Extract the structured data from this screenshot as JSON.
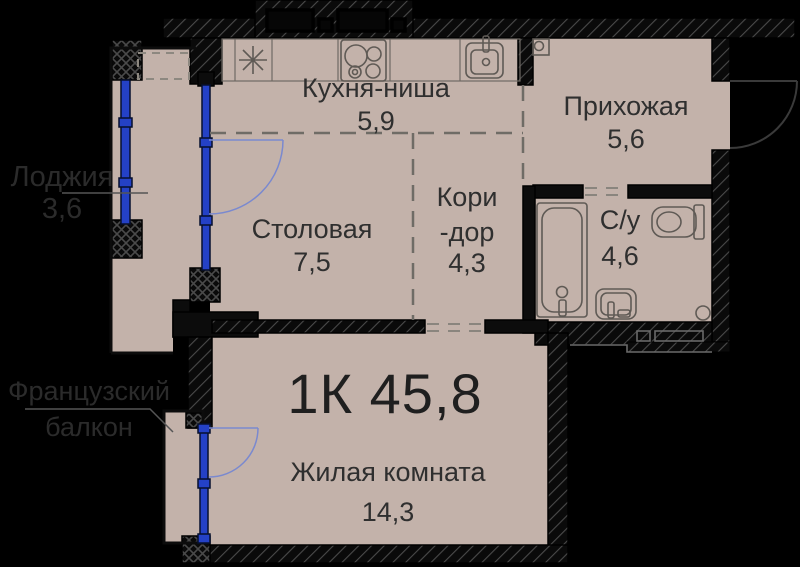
{
  "title": "1К 45,8",
  "rooms": {
    "kitchen": {
      "name": "Кухня-ниша",
      "area": "5,9"
    },
    "hallway": {
      "name": "Прихожая",
      "area": "5,6"
    },
    "dining": {
      "name": "Столовая",
      "area": "7,5"
    },
    "corridor": {
      "line1": "Кори",
      "line2": "-дор",
      "area": "4,3"
    },
    "bathroom": {
      "name": "С/у",
      "area": "4,6"
    },
    "living": {
      "name": "Жилая комната",
      "area": "14,3"
    },
    "loggia": {
      "name": "Лоджия",
      "area": "3,6"
    },
    "french_balcony": {
      "line1": "Французский",
      "line2": "балкон"
    }
  },
  "fixtures": {
    "kitchen_sink": "kitchen-sink-icon",
    "stove": "stove-icon",
    "wash_sink": "sink-icon",
    "meter_box": "meter-box-icon",
    "bathtub": "bathtub-icon",
    "toilet": "toilet-icon",
    "bathroom_sink": "sink-icon",
    "drain": "drain-icon"
  },
  "colors": {
    "background": "#000000",
    "floor": "#c3b2aa",
    "wall": "#0a0a0a",
    "wall_hatch": "#4a4a4a",
    "window_blue": "#2441c6",
    "door_arc_blue": "#7a89cf",
    "label": "#2f2f2f",
    "dash": "#6f6c66"
  }
}
